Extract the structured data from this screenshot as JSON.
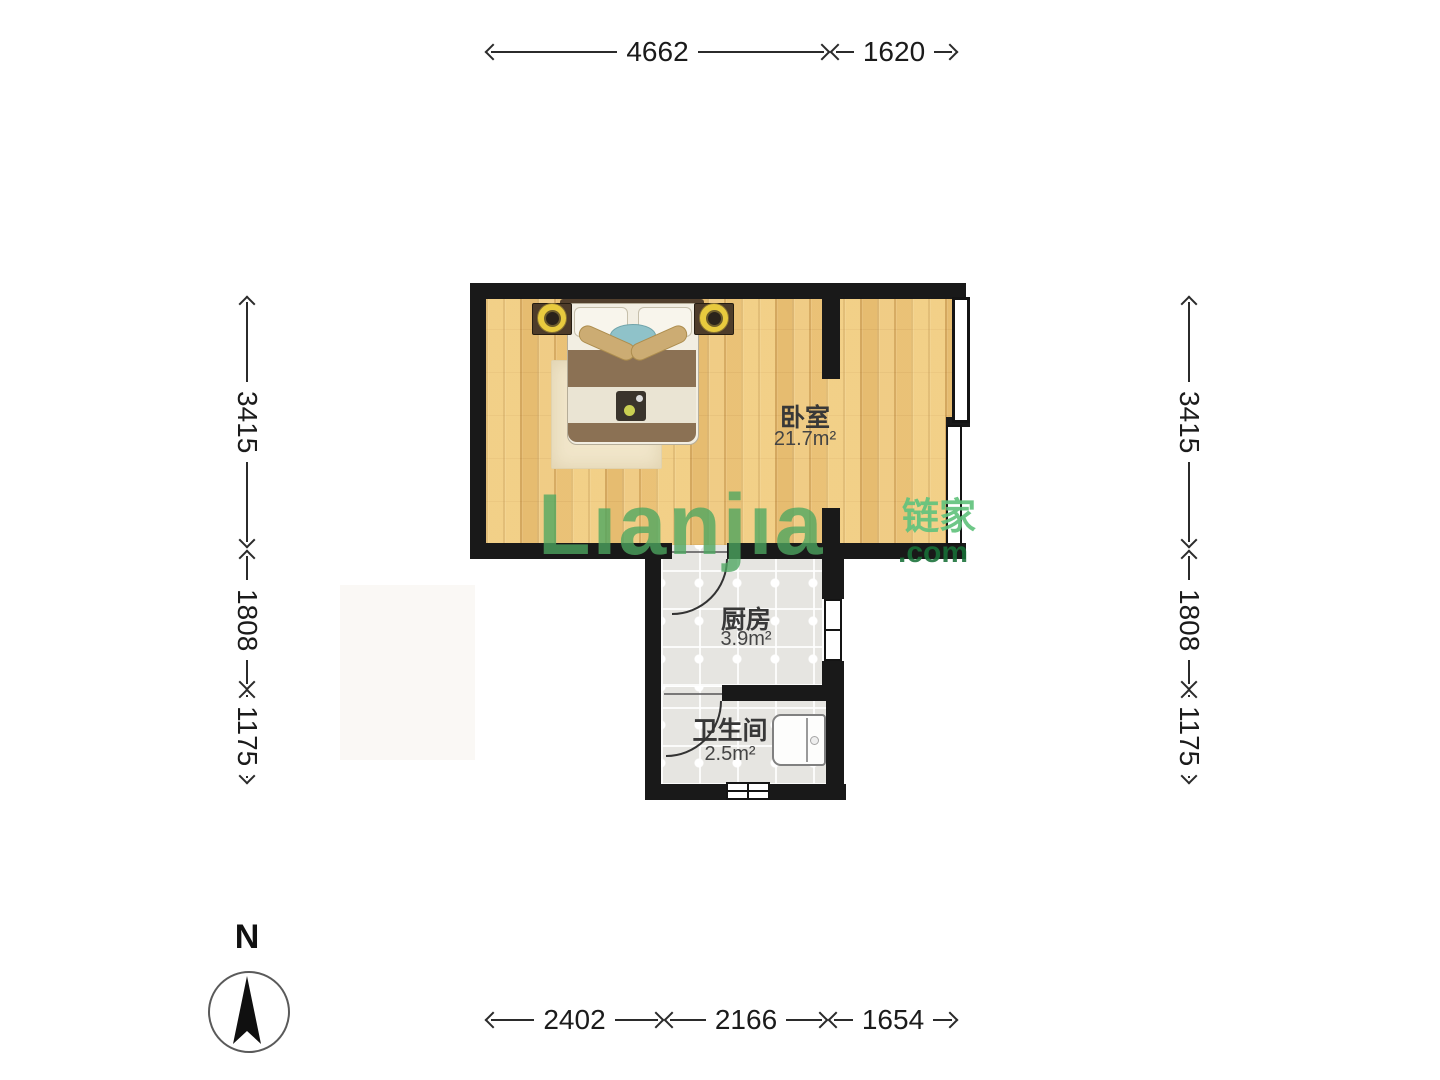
{
  "dims": {
    "top": [
      {
        "label": "4662"
      },
      {
        "label": "1620"
      }
    ],
    "bottom": [
      {
        "label": "2402"
      },
      {
        "label": "2166"
      },
      {
        "label": "1654"
      }
    ],
    "left": [
      {
        "label": "3415"
      },
      {
        "label": "1808"
      },
      {
        "label": "1175"
      }
    ],
    "right": [
      {
        "label": "3415"
      },
      {
        "label": "1808"
      },
      {
        "label": "1175"
      }
    ]
  },
  "rooms": {
    "bedroom": {
      "name": "卧室",
      "area": "21.7m²"
    },
    "kitchen": {
      "name": "厨房",
      "area": "3.9m²"
    },
    "bathroom": {
      "name": "卫生间",
      "area": "2.5m²"
    }
  },
  "compass": {
    "label": "N"
  },
  "watermark": {
    "brand": "Lıanjıa",
    "brand_cn": "链家",
    "suffix": ".com"
  },
  "colors": {
    "wall": "#191919",
    "wood_floor": "#edc67c",
    "tile_floor": "#e6e5e1",
    "watermark_green": "#4da760",
    "lamp_yellow": "#e8ca3e",
    "pillow_teal": "#8fc2c9",
    "blanket_brown": "#8b7154"
  }
}
